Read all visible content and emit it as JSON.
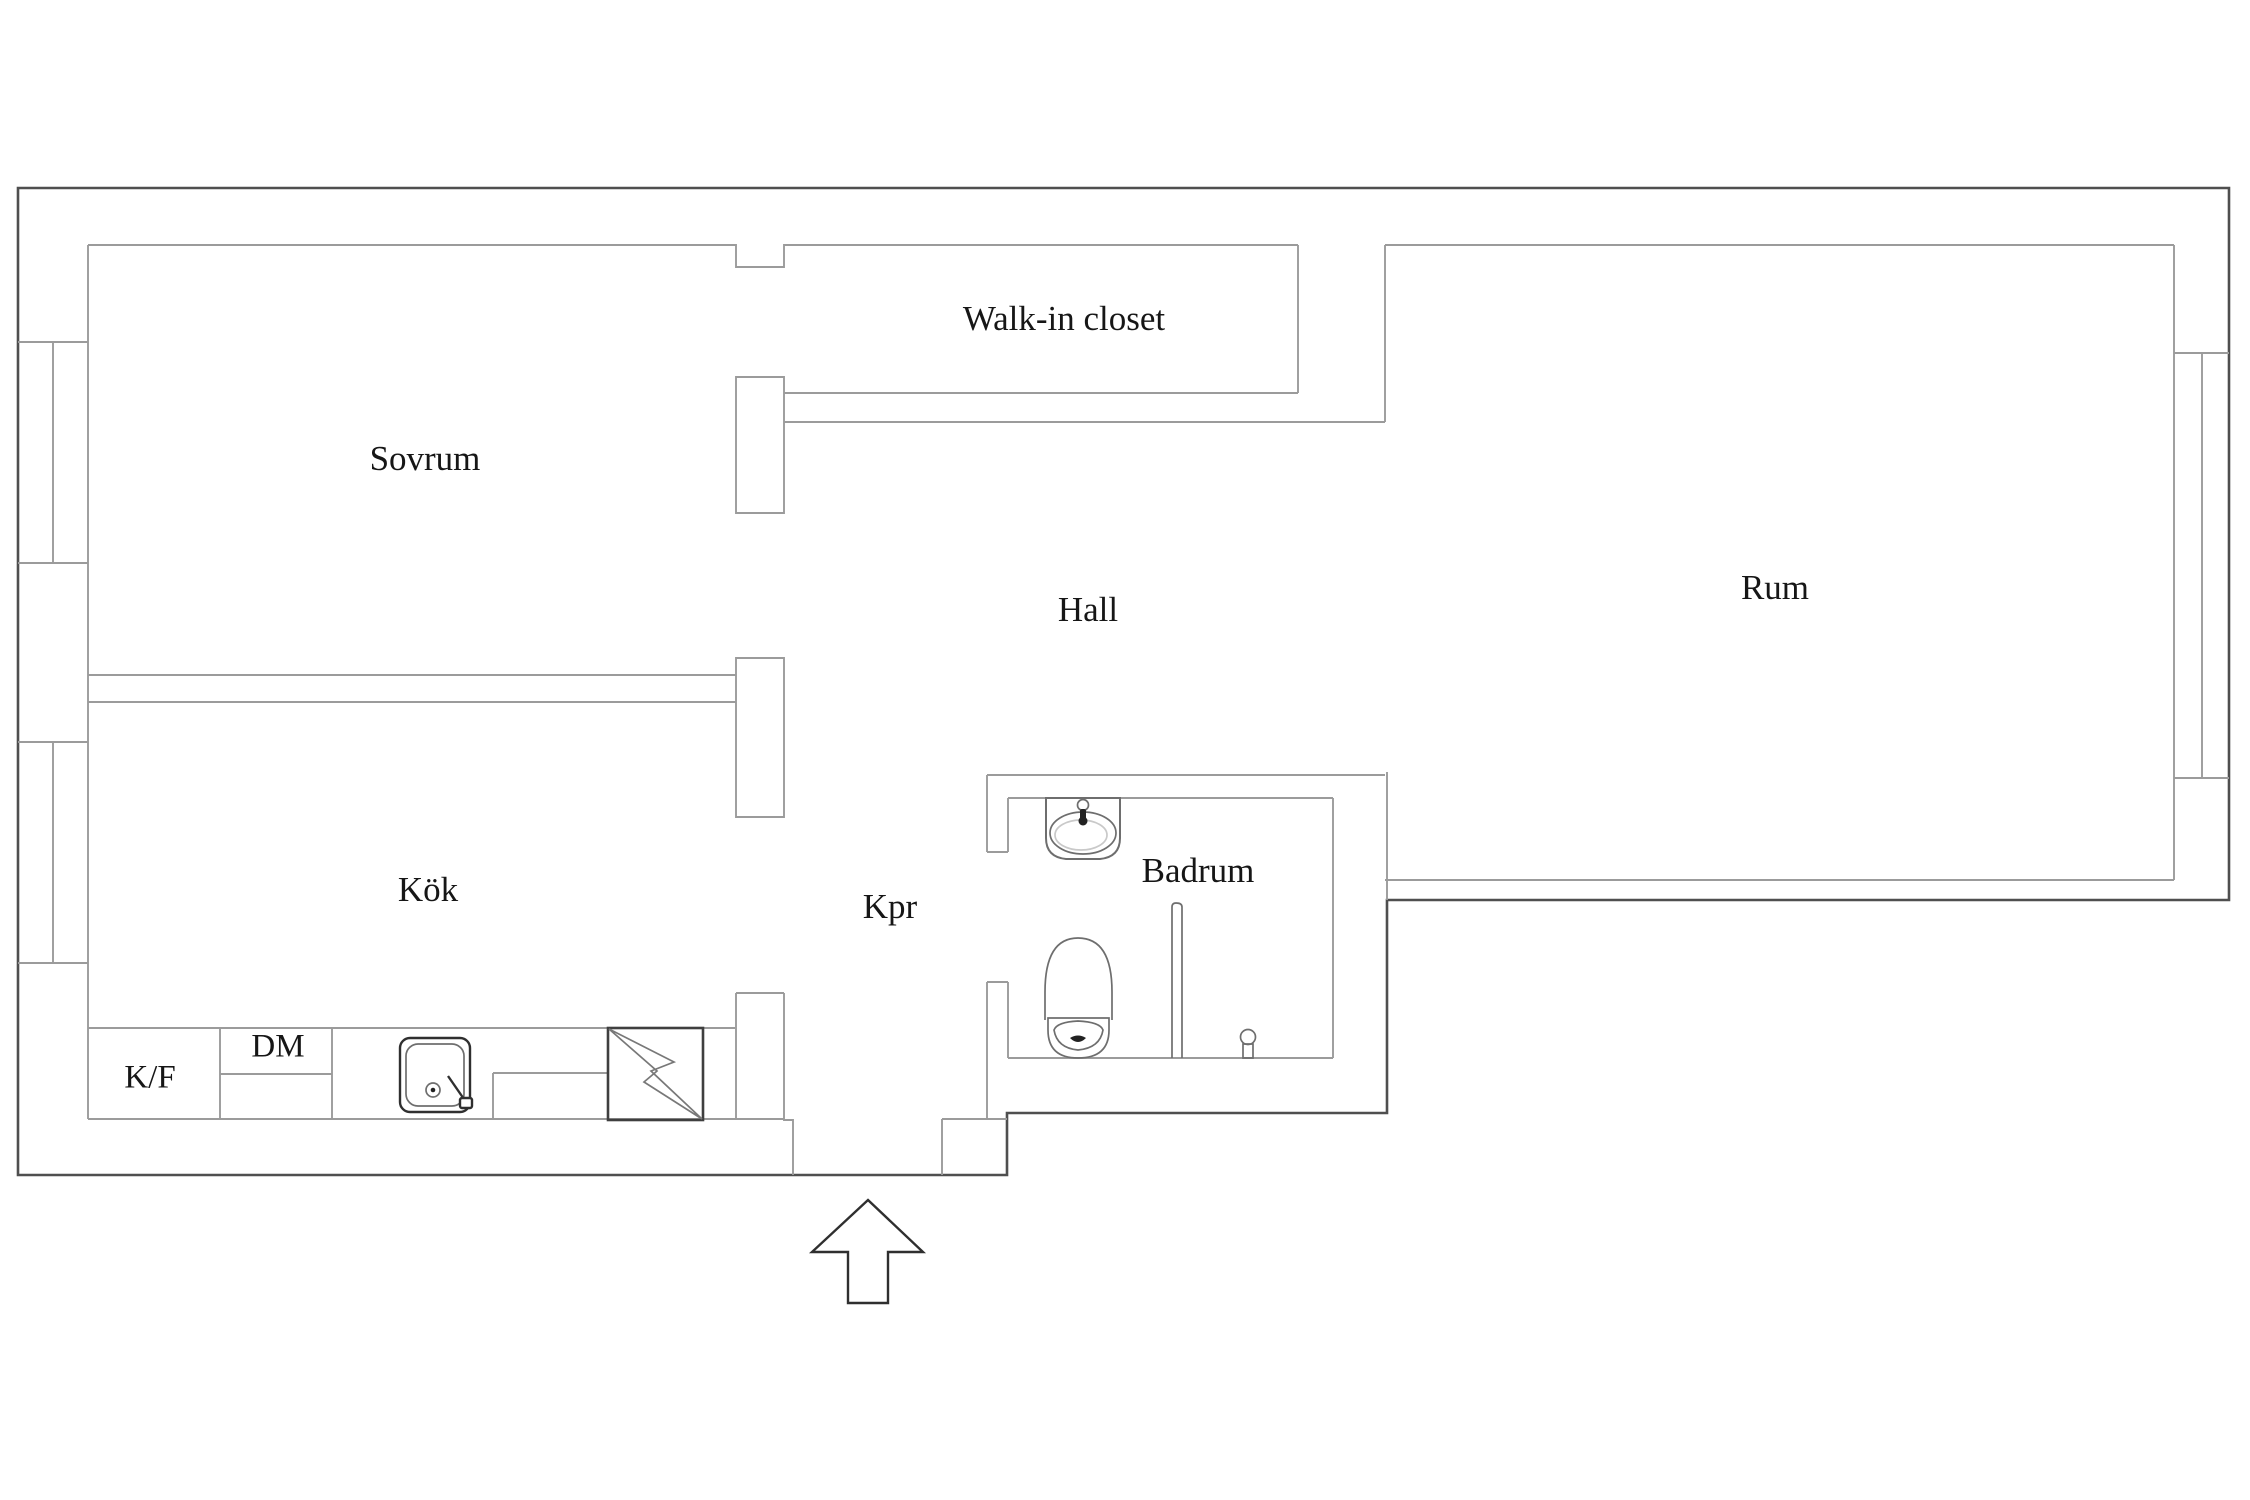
{
  "title": "Apartment floor plan",
  "labels": {
    "sovrum": "Sovrum",
    "walk_in_closet": "Walk-in closet",
    "hall": "Hall",
    "rum": "Rum",
    "kok": "Kök",
    "kpr": "Kpr",
    "badrum": "Badrum",
    "kf": "K/F",
    "dm": "DM"
  },
  "fixtures": [
    "kitchen-sink",
    "stove",
    "fridge-freezer-cabinet",
    "dishwasher-cabinet",
    "washbasin",
    "toilet",
    "shower-partition",
    "shower-tap",
    "entrance-arrow"
  ],
  "colors": {
    "background": "#ffffff",
    "outer_wall": "#4f4f4f",
    "inner_wall": "#9b9b9b",
    "fixture": "#6e6e6e",
    "text": "#161616"
  }
}
